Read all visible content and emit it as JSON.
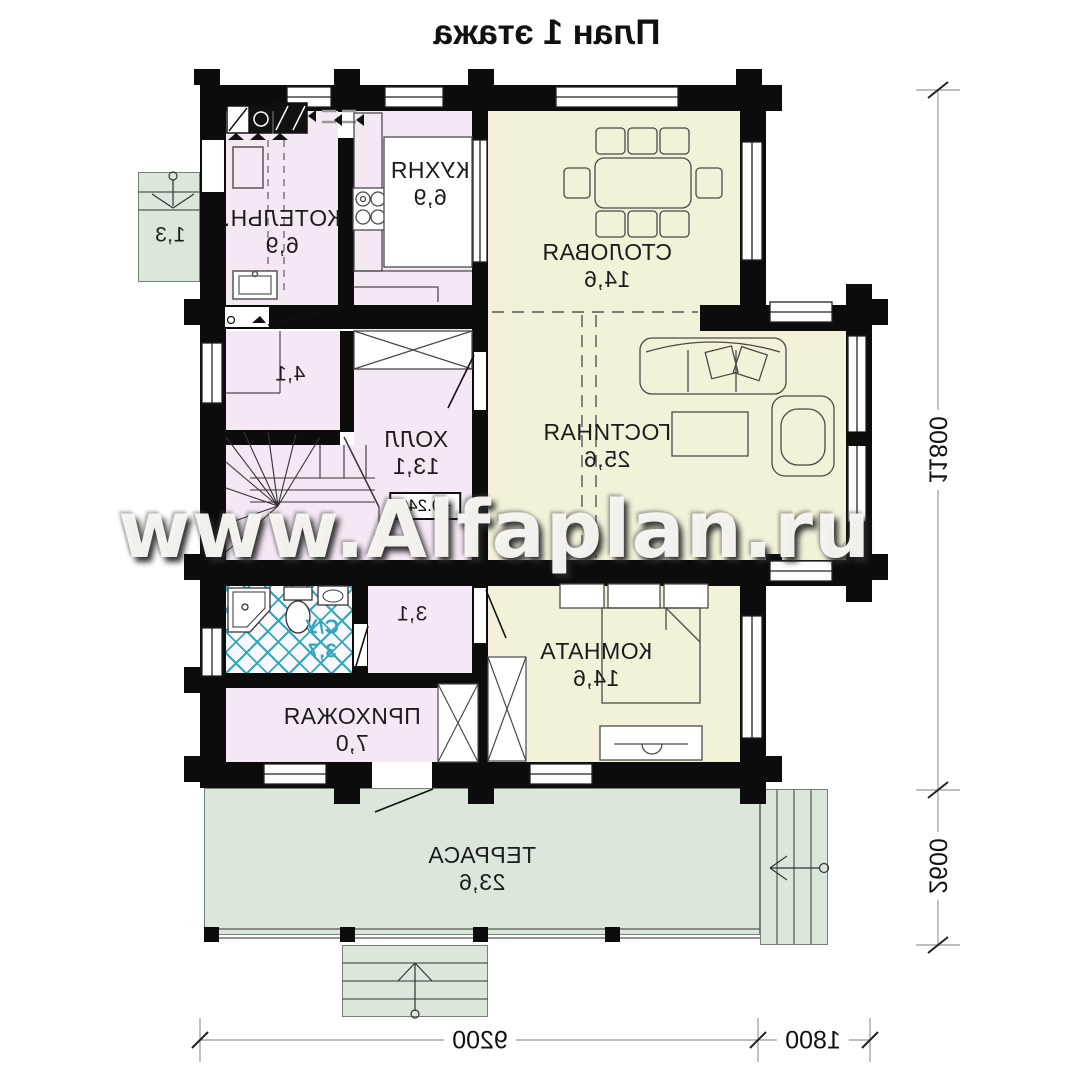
{
  "title": "План 1 этажа",
  "watermark": "www.Alfaplan.ru",
  "rooms": {
    "boiler": {
      "name": "КОТЕЛЬН.",
      "area": "6,9"
    },
    "kitchen": {
      "name": "КУХНЯ",
      "area": "6,9"
    },
    "dining": {
      "name": "СТОЛОВАЯ",
      "area": "14,6"
    },
    "room41": {
      "area": "4,1"
    },
    "hall": {
      "name": "ХОЛЛ",
      "area": "13,1",
      "elevation": "+0.240"
    },
    "living": {
      "name": "ГОСТИНАЯ",
      "area": "25,6"
    },
    "bath": {
      "name": "С/У",
      "area": "3,7"
    },
    "room31": {
      "area": "3,1"
    },
    "entry": {
      "name": "ПРИХОЖАЯ",
      "area": "7,0"
    },
    "bedroom": {
      "name": "КОМНАТА",
      "area": "14,6"
    },
    "terrace": {
      "name": "ТЕРРАСА",
      "area": "23,6"
    },
    "porch": {
      "area": "1,3"
    }
  },
  "dimensions": {
    "right_total": "11800",
    "right_terrace": "2600",
    "bottom_main": "9200",
    "bottom_right": "1800"
  },
  "colors": {
    "wall": "#0c0c0c",
    "room_pink": "#f4e8f4",
    "room_yellow": "#f3f2d8",
    "terrace_green": "#dbe7db",
    "tile_teal": "#2fa8bf"
  }
}
